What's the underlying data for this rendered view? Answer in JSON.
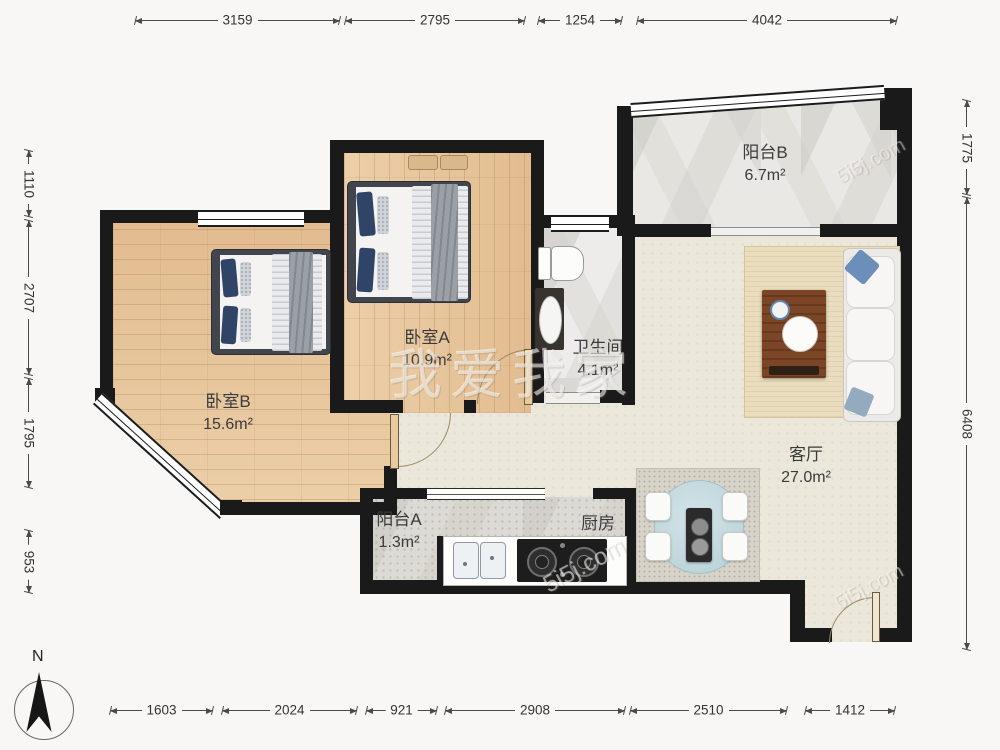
{
  "rooms": {
    "balcony_b": {
      "name": "阳台B",
      "area": "6.7m²"
    },
    "bedroom_a": {
      "name": "卧室A",
      "area": "10.9m²"
    },
    "bedroom_b": {
      "name": "卧室B",
      "area": "15.6m²"
    },
    "bathroom": {
      "name": "卫生间",
      "area": "4.1m²"
    },
    "living": {
      "name": "客厅",
      "area": "27.0m²"
    },
    "balcony_a": {
      "name": "阳台A",
      "area": "1.3m²"
    },
    "kitchen": {
      "name": "厨房"
    }
  },
  "dimensions": {
    "top": [
      "3159",
      "2795",
      "1254",
      "4042"
    ],
    "bottom": [
      "1603",
      "2024",
      "921",
      "2908",
      "2510",
      "1412"
    ],
    "left": [
      "1110",
      "2707",
      "1795",
      "953"
    ],
    "right": [
      "1775",
      "6408"
    ]
  },
  "compass": {
    "label": "N"
  },
  "watermark": {
    "brand": "我爱我家",
    "site": "5i5j.com"
  },
  "colors": {
    "wall": "#1a1a1a",
    "wood": "#e8c69e",
    "pillow_accent": "#2f4467"
  }
}
